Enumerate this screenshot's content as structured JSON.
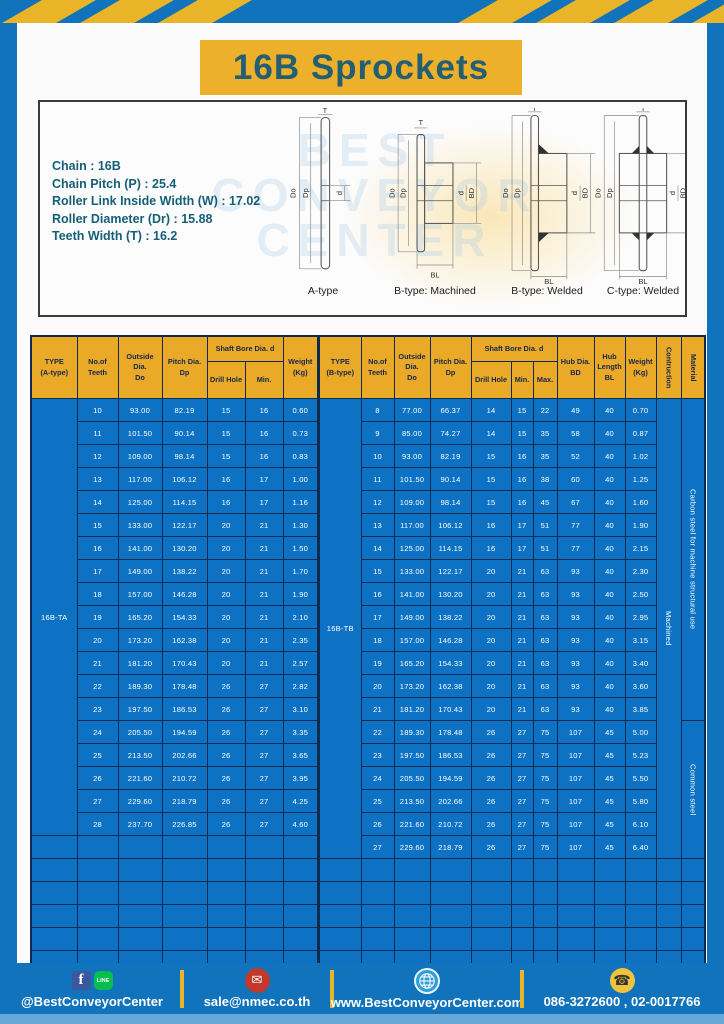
{
  "page": {
    "title": "16B Sprockets"
  },
  "watermark": {
    "text": "BEST\nCONVEYOR\nCENTER"
  },
  "specs": {
    "lines": [
      "Chain  :  16B",
      "Chain Pitch (P)  :  25.4",
      "Roller Link Inside Width (W)  :  17.02",
      "Roller Diameter (Dr)  : 15.88",
      "Teeth Width (T)  :  16.2"
    ]
  },
  "diagrams": {
    "captions": [
      "A-type",
      "B-type: Machined",
      "B-type: Welded",
      "C-type: Welded"
    ],
    "labels": {
      "T": "T",
      "Do": "Do",
      "Dp": "Dp",
      "d": "d",
      "BD": "BD",
      "BL": "BL"
    }
  },
  "table_a": {
    "type_label": "16B-TA",
    "headers": {
      "type": "TYPE\n(A-type)",
      "teeth": "No.of\nTeeth",
      "outside": "Outside\nDia.\nDo",
      "pitch": "Pitch Dia.\nDp",
      "shaft_bore": "Shaft Bore Dia. d",
      "drill": "Drill Hole",
      "min": "Min.",
      "weight": "Weight\n(Kg)"
    },
    "rows": [
      [
        "10",
        "93.00",
        "82.19",
        "15",
        "16",
        "0.60"
      ],
      [
        "11",
        "101.50",
        "90.14",
        "15",
        "16",
        "0.73"
      ],
      [
        "12",
        "109.00",
        "98.14",
        "15",
        "16",
        "0.83"
      ],
      [
        "13",
        "117.00",
        "106.12",
        "16",
        "17",
        "1.00"
      ],
      [
        "14",
        "125.00",
        "114.15",
        "16",
        "17",
        "1.16"
      ],
      [
        "15",
        "133.00",
        "122.17",
        "20",
        "21",
        "1.30"
      ],
      [
        "16",
        "141.00",
        "130.20",
        "20",
        "21",
        "1.50"
      ],
      [
        "17",
        "149.00",
        "138.22",
        "20",
        "21",
        "1.70"
      ],
      [
        "18",
        "157.00",
        "146.28",
        "20",
        "21",
        "1.90"
      ],
      [
        "19",
        "165.20",
        "154.33",
        "20",
        "21",
        "2.10"
      ],
      [
        "20",
        "173.20",
        "162.38",
        "20",
        "21",
        "2.35"
      ],
      [
        "21",
        "181.20",
        "170.43",
        "20",
        "21",
        "2.57"
      ],
      [
        "22",
        "189.30",
        "178.48",
        "26",
        "27",
        "2.82"
      ],
      [
        "23",
        "197.50",
        "186.53",
        "26",
        "27",
        "3.10"
      ],
      [
        "24",
        "205.50",
        "194.59",
        "26",
        "27",
        "3.35"
      ],
      [
        "25",
        "213.50",
        "202.66",
        "26",
        "27",
        "3.65"
      ],
      [
        "26",
        "221.60",
        "210.72",
        "26",
        "27",
        "3.95"
      ],
      [
        "27",
        "229.60",
        "218.79",
        "26",
        "27",
        "4.25"
      ],
      [
        "28",
        "237.70",
        "226.85",
        "26",
        "27",
        "4.60"
      ]
    ],
    "empty_rows": 6,
    "columns": 7
  },
  "table_b": {
    "type_label": "16B-TB",
    "headers": {
      "type": "TYPE\n(B-type)",
      "teeth": "No.of\nTeeth",
      "outside": "Outside\nDia.\nDo",
      "pitch": "Pitch Dia.\nDp",
      "shaft_bore": "Shaft Bore Dia. d",
      "drill": "Drill Hole",
      "min": "Min.",
      "max": "Max.",
      "hub_dia": "Hub Dia.\nBD",
      "hub_len": "Hub\nLength\nBL",
      "weight": "Weight\n(Kg)",
      "construction": "Contruction",
      "material": "Material"
    },
    "rows": [
      [
        "8",
        "77.00",
        "66.37",
        "14",
        "15",
        "22",
        "49",
        "40",
        "0.70"
      ],
      [
        "9",
        "85.00",
        "74.27",
        "14",
        "15",
        "35",
        "58",
        "40",
        "0.87"
      ],
      [
        "10",
        "93.00",
        "82.19",
        "15",
        "16",
        "35",
        "52",
        "40",
        "1.02"
      ],
      [
        "11",
        "101.50",
        "90.14",
        "15",
        "16",
        "38",
        "60",
        "40",
        "1.25"
      ],
      [
        "12",
        "109.00",
        "98.14",
        "15",
        "16",
        "45",
        "67",
        "40",
        "1.60"
      ],
      [
        "13",
        "117.00",
        "106.12",
        "16",
        "17",
        "51",
        "77",
        "40",
        "1.90"
      ],
      [
        "14",
        "125.00",
        "114.15",
        "16",
        "17",
        "51",
        "77",
        "40",
        "2.15"
      ],
      [
        "15",
        "133.00",
        "122.17",
        "20",
        "21",
        "63",
        "93",
        "40",
        "2.30"
      ],
      [
        "16",
        "141.00",
        "130.20",
        "20",
        "21",
        "63",
        "93",
        "40",
        "2.50"
      ],
      [
        "17",
        "149.00",
        "138.22",
        "20",
        "21",
        "63",
        "93",
        "40",
        "2.95"
      ],
      [
        "18",
        "157.00",
        "146.28",
        "20",
        "21",
        "63",
        "93",
        "40",
        "3.15"
      ],
      [
        "19",
        "165.20",
        "154.33",
        "20",
        "21",
        "63",
        "93",
        "40",
        "3.40"
      ],
      [
        "20",
        "173.20",
        "162.38",
        "20",
        "21",
        "63",
        "93",
        "40",
        "3.60"
      ],
      [
        "21",
        "181.20",
        "170.43",
        "20",
        "21",
        "63",
        "93",
        "40",
        "3.85"
      ],
      [
        "22",
        "189.30",
        "178.48",
        "26",
        "27",
        "75",
        "107",
        "45",
        "5.00"
      ],
      [
        "23",
        "197.50",
        "186.53",
        "26",
        "27",
        "75",
        "107",
        "45",
        "5.23"
      ],
      [
        "24",
        "205.50",
        "194.59",
        "26",
        "27",
        "75",
        "107",
        "45",
        "5.50"
      ],
      [
        "25",
        "213.50",
        "202.66",
        "26",
        "27",
        "75",
        "107",
        "45",
        "5.80"
      ],
      [
        "26",
        "221.60",
        "210.72",
        "26",
        "27",
        "75",
        "107",
        "45",
        "6.10"
      ],
      [
        "27",
        "229.60",
        "218.79",
        "26",
        "27",
        "75",
        "107",
        "45",
        "6.40"
      ]
    ],
    "construction_value": "Machined",
    "materials": [
      {
        "label": "Carbon steel for machine structural use",
        "rows": 14
      },
      {
        "label": "Common steel",
        "rows": 6
      }
    ],
    "empty_rows": 5,
    "columns": 12
  },
  "footer": {
    "social": "@BestConveyorCenter",
    "email": "sale@nmec.co.th",
    "website": "www.BestConveyorCenter.com",
    "phone": "086-3272600 , 02-0017766",
    "line_label": "LINE",
    "fb_label": "f"
  },
  "colors": {
    "frame_blue": "#1173BB",
    "stripe_yellow": "#E9B427",
    "title_yellow": "#ECB02A",
    "title_teal": "#235E73",
    "table_header_yellow": "#EBA928",
    "table_body_blue": "#0D72C3",
    "border_navy": "#0E2A4E",
    "spec_teal": "#156077"
  }
}
